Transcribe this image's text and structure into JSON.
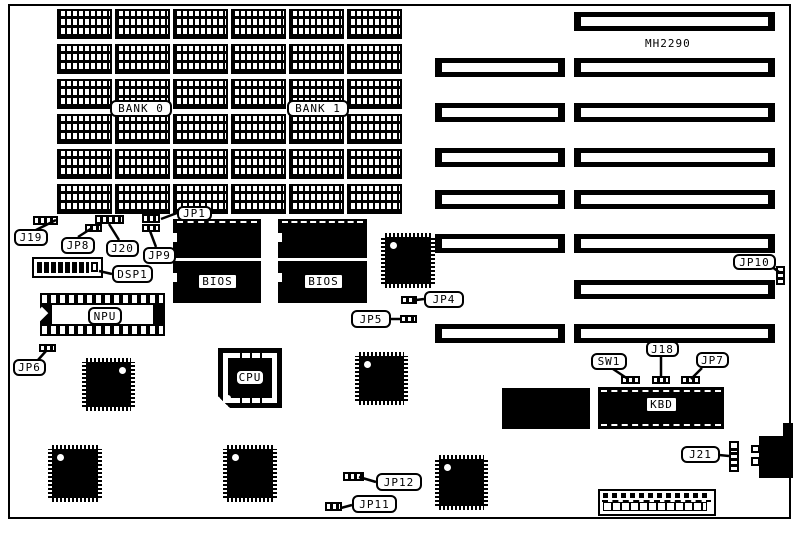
{
  "labels": {
    "model": "MH2290",
    "bank0": "BANK 0",
    "bank1": "BANK 1",
    "bios": "BIOS",
    "npu": "NPU",
    "cpu": "CPU",
    "kbd": "KBD",
    "dsp1": "DSP1",
    "j19": "J19",
    "jp8": "JP8",
    "j20": "J20",
    "jp9": "JP9",
    "jp1": "JP1",
    "jp6": "JP6",
    "jp4": "JP4",
    "jp5": "JP5",
    "jp10": "JP10",
    "sw1": "SW1",
    "j18": "J18",
    "jp7": "JP7",
    "j21": "J21",
    "jp12": "JP12",
    "jp11": "JP11"
  },
  "memory": {
    "rows": 6,
    "cols": 6
  },
  "slots": {
    "left": 6,
    "right": 8
  },
  "colors": {
    "ink": "#000000",
    "paper": "#ffffff"
  }
}
